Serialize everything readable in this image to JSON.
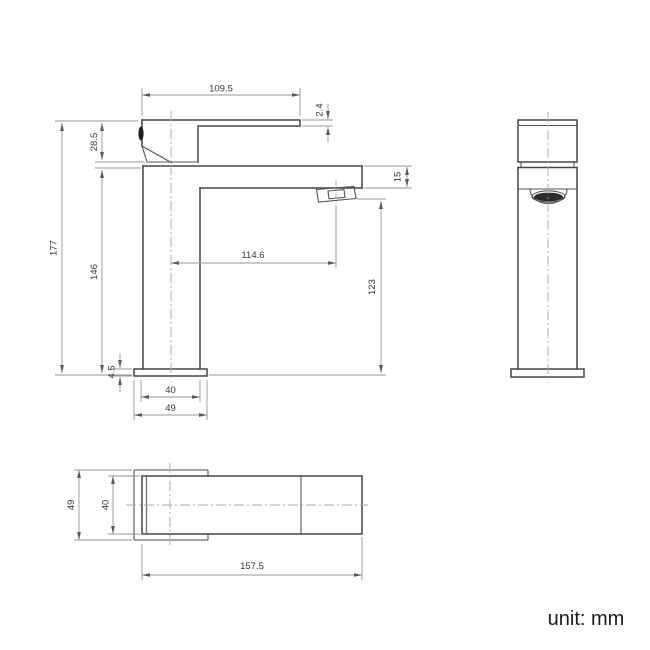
{
  "unit_note": "unit: mm",
  "drawing": {
    "colors": {
      "object_line": "#454545",
      "dimension_line": "#979797",
      "centerline": "#a8a8a8",
      "text": "#383838",
      "aerator_fill": "#2d2d2d",
      "background": "#ffffff"
    },
    "views": {
      "front": {
        "dimensions": {
          "lever_length": "109.5",
          "lever_tip_thickness": "2.4",
          "handle_rise": "28.5",
          "overall_height": "177",
          "body_height": "146",
          "spout_height": "15",
          "spout_reach": "114.6",
          "outlet_height": "123",
          "base_thickness": "4.5",
          "body_width": "40",
          "base_width": "49"
        }
      },
      "side": {
        "dimensions": {}
      },
      "top": {
        "dimensions": {
          "base_depth": "49",
          "lever_width": "40",
          "overall_length": "157.5"
        }
      }
    }
  }
}
